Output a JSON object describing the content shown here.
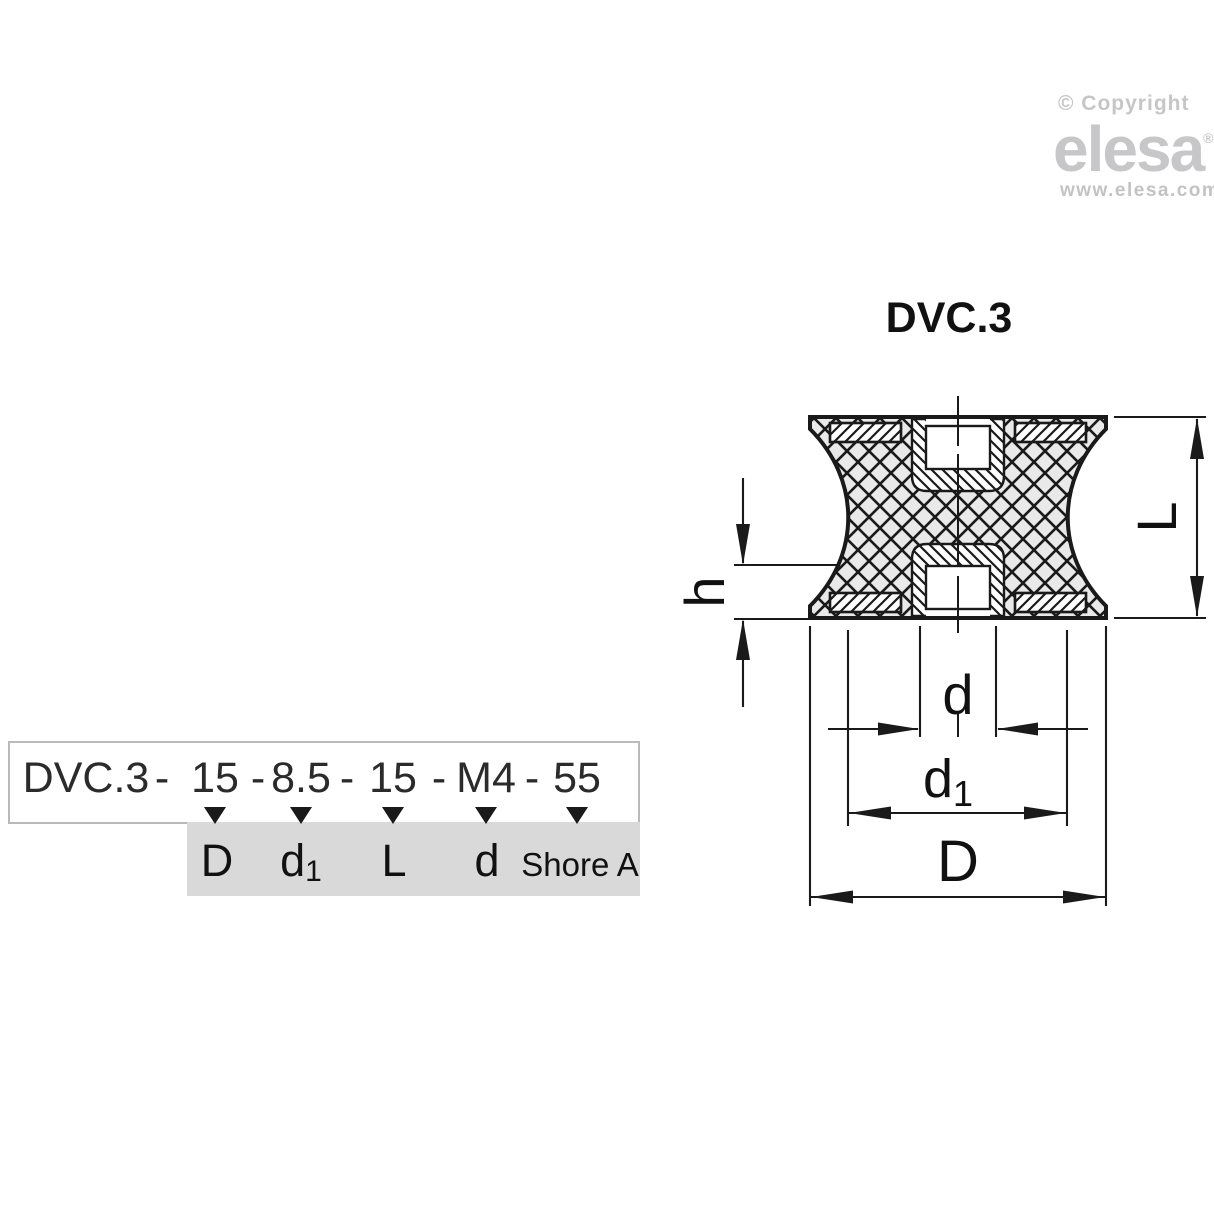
{
  "branding": {
    "copyright": "© Copyright",
    "logo": "elesa",
    "registered": "®",
    "website": "www.elesa.com"
  },
  "drawing": {
    "title": "DVC.3",
    "labels": {
      "L": "L",
      "h": "h",
      "d": "d",
      "d1_base": "d",
      "d1_sub": "1",
      "D": "D"
    }
  },
  "ordering_code": {
    "tokens": [
      "DVC.3",
      "-",
      "15",
      "-",
      "8.5",
      "-",
      "15",
      "-",
      "M4",
      "-",
      "55"
    ],
    "legend": [
      {
        "base": "D",
        "sub": ""
      },
      {
        "base": "d",
        "sub": "1"
      },
      {
        "base": "L",
        "sub": ""
      },
      {
        "base": "d",
        "sub": ""
      },
      {
        "base": "Shore A",
        "sub": ""
      }
    ]
  },
  "colors": {
    "line": "#1a1a1a",
    "rubber_fill": "#e9e9e9",
    "legend_bg": "#d9d9d9",
    "box_border": "#b9b9b9",
    "watermark_gray": "#c7c7c9"
  }
}
